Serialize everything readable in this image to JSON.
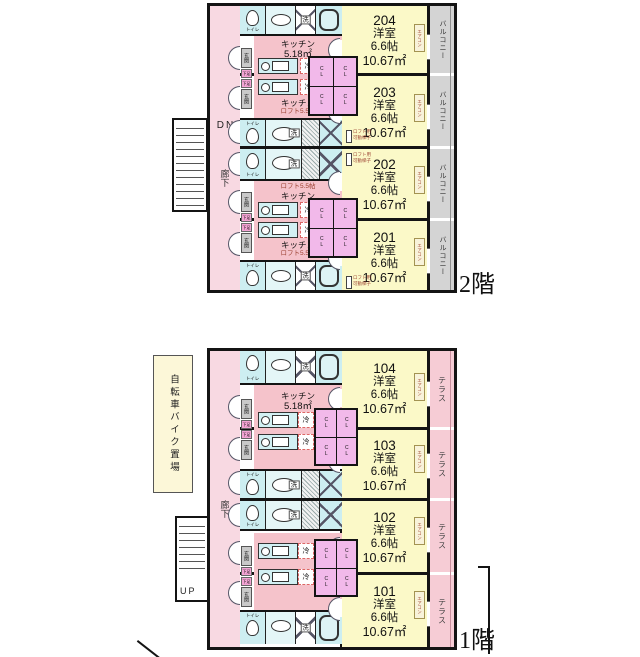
{
  "labels": {
    "toilet": "トイレ",
    "washer": "洗",
    "fridge": "冷",
    "closet": "CL",
    "entrance": "玄関",
    "shoe_box": "下足",
    "corridor": "廊下",
    "kitchen": "キッチン",
    "kitchen_area": "5.18㎡",
    "loft": "ロフト5.5帖",
    "loft_ladder_line1": "ロフト用",
    "loft_ladder_line2": "可動梯子",
    "aircon": "エアコン",
    "balcony": "バルコニー",
    "terrace": "テラス",
    "stairs_down": "DN",
    "stairs_up": "UP",
    "bike_parking": "自転車バイク置場"
  },
  "floors": [
    {
      "name": "2階",
      "outdoor": "バルコニー",
      "units": [
        {
          "number": "204",
          "type": "洋室",
          "jo": "6.6帖",
          "m2": "10.67㎡"
        },
        {
          "number": "203",
          "type": "洋室",
          "jo": "6.6帖",
          "m2": "10.67㎡"
        },
        {
          "number": "202",
          "type": "洋室",
          "jo": "6.6帖",
          "m2": "10.67㎡"
        },
        {
          "number": "201",
          "type": "洋室",
          "jo": "6.6帖",
          "m2": "10.67㎡"
        }
      ]
    },
    {
      "name": "1階",
      "outdoor": "テラス",
      "units": [
        {
          "number": "104",
          "type": "洋室",
          "jo": "6.6帖",
          "m2": "10.67㎡"
        },
        {
          "number": "103",
          "type": "洋室",
          "jo": "6.6帖",
          "m2": "10.67㎡"
        },
        {
          "number": "102",
          "type": "洋室",
          "jo": "6.6帖",
          "m2": "10.67㎡"
        },
        {
          "number": "101",
          "type": "洋室",
          "jo": "6.6帖",
          "m2": "10.67㎡"
        }
      ]
    }
  ],
  "colors": {
    "wall": "#141414",
    "room_fill": "#fbf9c8",
    "corridor_fill": "#f8d9e2",
    "kitchen_fill": "#f5c3cb",
    "fixture_fill": "#cdeef1",
    "closet_fill": "#f2b9ea",
    "balcony_fill": "#d4d4d4",
    "terrace_fill": "#f6ccd5"
  }
}
